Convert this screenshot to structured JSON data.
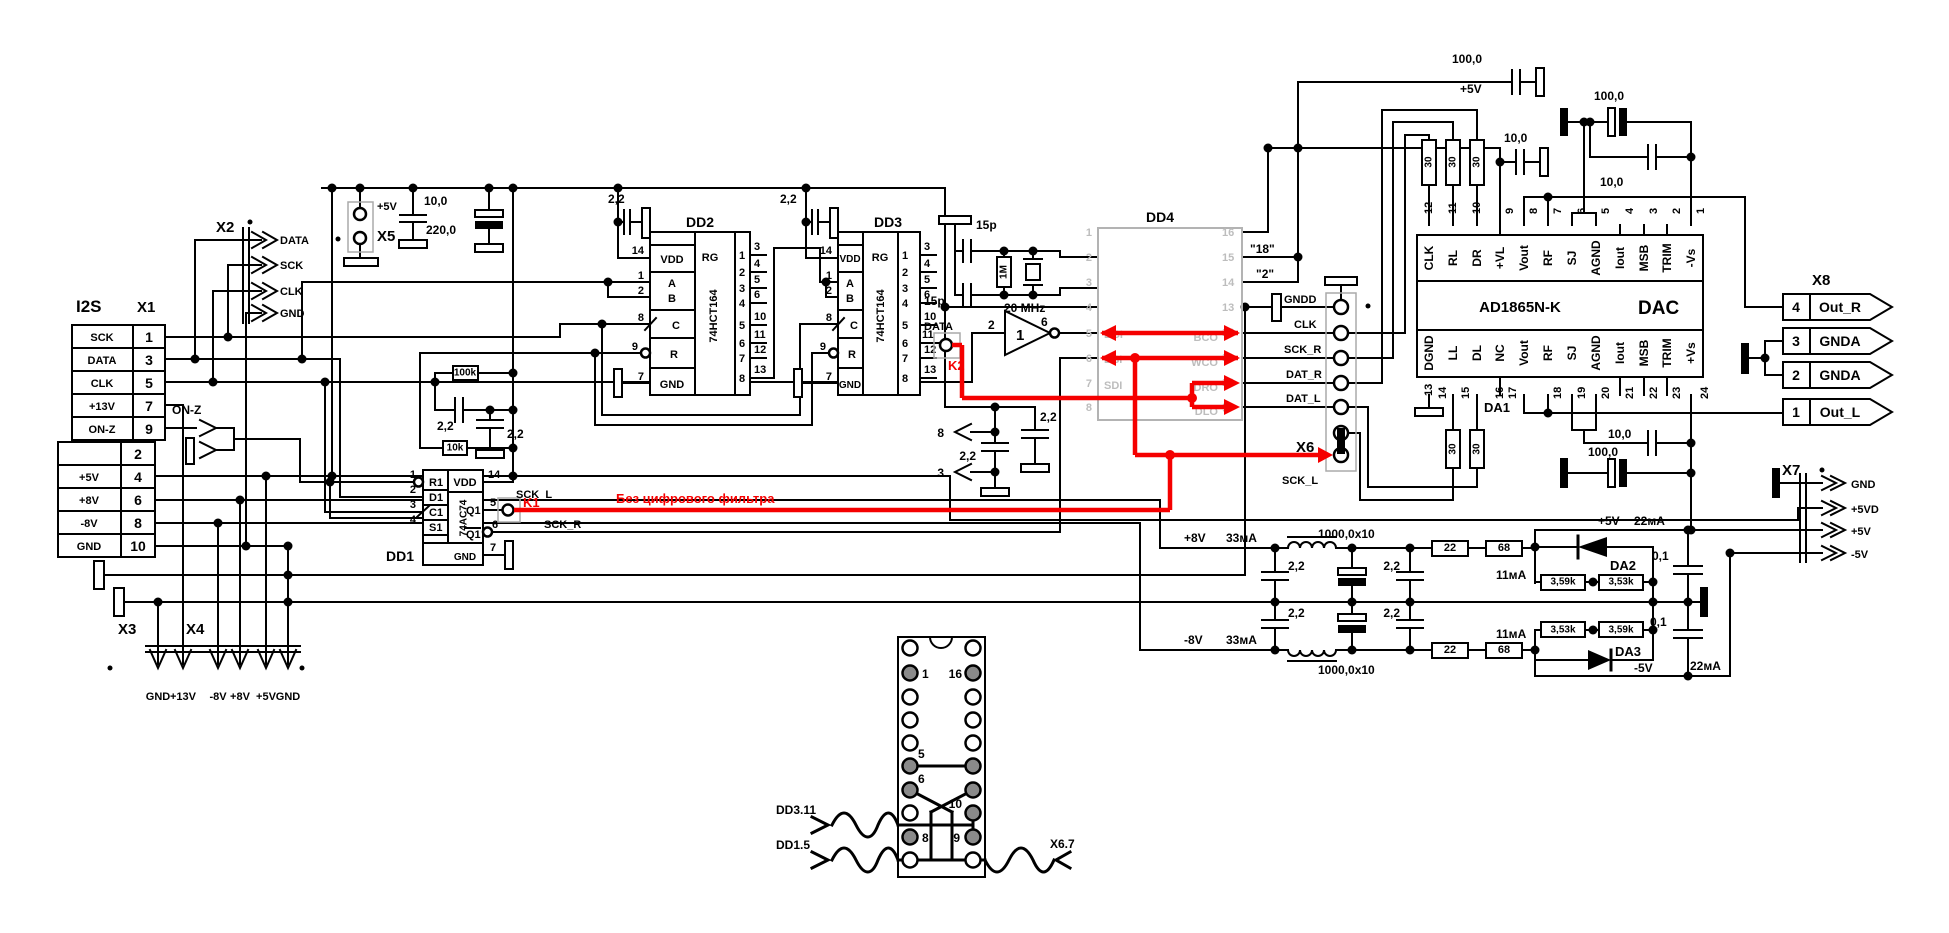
{
  "note": "Без цифрового фильтра",
  "g": {
    "c22": "2,2",
    "c10": "10,0",
    "c100": "100,0",
    "c220": "220,0",
    "p15": "15p",
    "c1000": "1000,0x10",
    "c01": "0,1",
    "r30": "30",
    "r22": "22",
    "r68": "68",
    "rk100": "100k",
    "rk10": "10k",
    "r1m": "1M",
    "r359": "3,59k",
    "r353": "3,53k",
    "i33": "33мА",
    "i11": "11мА",
    "i22": "22мА",
    "mhz": "20 MHz"
  },
  "n": {
    "p5": "+5V",
    "p5d": "+5VD",
    "p8": "+8V",
    "m8": "-8V",
    "m5": "-5V",
    "p13": "+13V",
    "gnd": "GND",
    "sck": "SCK",
    "data": "DATA",
    "clk": "CLK",
    "onz": "ON-Z",
    "i2s": "I2S"
  },
  "x1": {
    "id": "X1",
    "rows": [
      {
        "l": "SCK",
        "p": "1"
      },
      {
        "l": "DATA",
        "p": "3"
      },
      {
        "l": "CLK",
        "p": "5"
      },
      {
        "l": "+13V",
        "p": "7"
      },
      {
        "l": "ON-Z",
        "p": "9"
      },
      {
        "l": "",
        "p": "2"
      },
      {
        "l": "+5V",
        "p": "4"
      },
      {
        "l": "+8V",
        "p": "6"
      },
      {
        "l": "-8V",
        "p": "8"
      },
      {
        "l": "GND",
        "p": "10"
      }
    ]
  },
  "x2": {
    "id": "X2"
  },
  "x3": {
    "id": "X3"
  },
  "x4": {
    "id": "X4"
  },
  "x5": {
    "id": "X5"
  },
  "x6": {
    "id": "X6"
  },
  "x7": {
    "id": "X7"
  },
  "x8": {
    "id": "X8",
    "rows": [
      {
        "p": "4",
        "l": "Out_R"
      },
      {
        "p": "3",
        "l": "GNDA"
      },
      {
        "p": "2",
        "l": "GNDA"
      },
      {
        "p": "1",
        "l": "Out_L"
      }
    ]
  },
  "dd1": {
    "id": "DD1",
    "part": "74AC74",
    "k": "K1",
    "sl": "SCK_L",
    "sr": "SCK_R",
    "p": {
      "r1": "R1",
      "d1": "D1",
      "c1": "C1",
      "s1": "S1",
      "vdd": "VDD",
      "q1": "Q1",
      "q1n": "Q1",
      "gnd": "GND"
    },
    "nn": {
      "a": "1",
      "b": "2",
      "c": "3",
      "d": "4",
      "e": "14",
      "f": "5",
      "g": "6",
      "h": "7"
    }
  },
  "dd2": {
    "id": "DD2",
    "part": "74HCT164",
    "rg": "RG",
    "l": [
      "VDD",
      "A",
      "B",
      "C",
      "R",
      "GND"
    ],
    "ln": [
      "14",
      "1",
      "2",
      "8",
      "9",
      "7"
    ],
    "i": [
      "1",
      "2",
      "3",
      "4",
      "5",
      "6",
      "7",
      "8"
    ],
    "o": [
      "3",
      "4",
      "5",
      "6",
      "10",
      "11",
      "12",
      "13"
    ]
  },
  "dd3": {
    "id": "DD3",
    "part": "74HCT164",
    "rg": "RG",
    "l": [
      "VDD",
      "A",
      "B",
      "C",
      "R",
      "GND"
    ],
    "ln": [
      "14",
      "1",
      "2",
      "8",
      "9",
      "7"
    ],
    "i": [
      "1",
      "2",
      "3",
      "4",
      "5",
      "6",
      "7",
      "8"
    ],
    "o": [
      "3",
      "4",
      "5",
      "6",
      "10",
      "11",
      "12",
      "13"
    ]
  },
  "dd4": {
    "id": "DD4",
    "k": "K2",
    "data": "DATA",
    "inv": "1",
    "iin": "2",
    "iout": "6",
    "a8": "8",
    "a3": "3",
    "sl": "SCK_L",
    "ln": [
      "1",
      "2",
      "3",
      "4",
      "5",
      "6",
      "7",
      "8"
    ],
    "rn": [
      "16",
      "15",
      "14",
      "13",
      "12",
      "11",
      "10",
      "9"
    ],
    "ls": [
      "",
      "",
      "",
      "",
      "BCI",
      "DSI",
      "SDI",
      ""
    ],
    "rs": [
      "",
      "",
      "",
      "",
      "BCO",
      "WCO",
      "DRO",
      "DLO"
    ],
    "rl": [
      "",
      "\"18\"",
      "\"2\"",
      "GNDD",
      "CLK",
      "SCK_R",
      "DAT_R",
      "DAT_L"
    ]
  },
  "dac": {
    "id": "DA1",
    "part": "AD1865N-K",
    "fn": "DAC",
    "tn": [
      "12",
      "11",
      "10",
      "9",
      "8",
      "7",
      "6",
      "5",
      "4",
      "3",
      "2",
      "1"
    ],
    "tl": [
      "CLK",
      "RL",
      "DR",
      "+VL",
      "Vout",
      "RF",
      "SJ",
      "AGND",
      "Iout",
      "MSB",
      "TRIM",
      "-Vs"
    ],
    "bn": [
      "13",
      "14",
      "15",
      "16",
      "17",
      "18",
      "19",
      "20",
      "21",
      "22",
      "23",
      "24"
    ],
    "bl": [
      "DGND",
      "LL",
      "DL",
      "NC",
      "Vout",
      "RF",
      "SJ",
      "AGND",
      "Iout",
      "MSB",
      "TRIM",
      "+Vs"
    ]
  },
  "da2": {
    "id": "DA2"
  },
  "da3": {
    "id": "DA3"
  },
  "sock": {
    "n1": "1",
    "n16": "16",
    "n5": "5",
    "n6": "6",
    "n10": "10",
    "n8": "8",
    "n9": "9",
    "a": "DD3.11",
    "b": "DD1.5",
    "c": "X6.7"
  }
}
